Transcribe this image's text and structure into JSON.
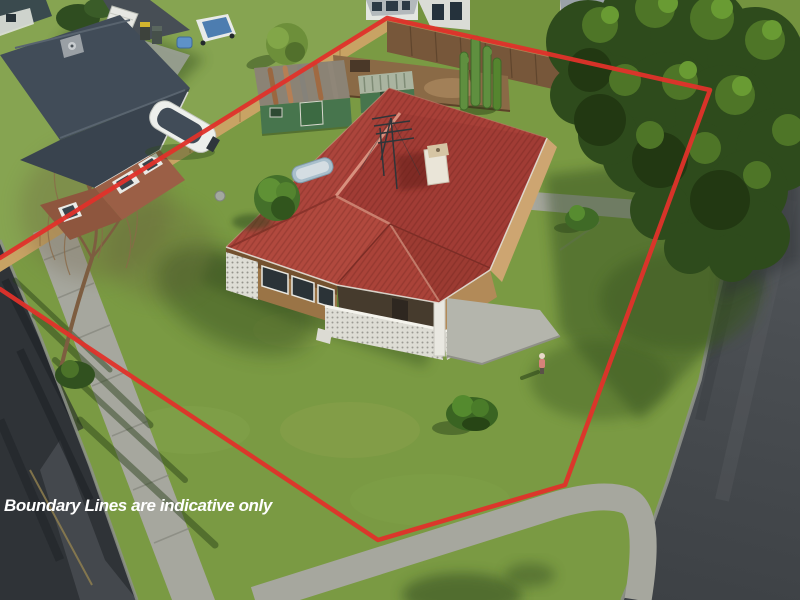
{
  "caption": {
    "text": "Boundary Lines are indicative only"
  },
  "overlay": {
    "points": "0,258 387,18 710,90 565,485 378,540 0,289",
    "description": "red property boundary outline"
  },
  "objects": [
    "main house with red corrugated hip roof",
    "white chimney",
    "tv antenna",
    "breeze-block balustrade and patio",
    "back fence",
    "two green garden sheds",
    "cactus plant",
    "large trees on right",
    "bare birch tree on left",
    "neighbour house with dark roof and boat",
    "wheelie bins",
    "corner roads with kerbs",
    "concrete footpaths",
    "person on lawn",
    "garden shrubs"
  ],
  "colors": {
    "lawn": "#7a9a43",
    "lawn2": "#86a451",
    "lawn-top": "#74933f",
    "road-dark": "#2f3337",
    "curb": "#8d908a",
    "path": "#a6a79e",
    "roof": "#a84038",
    "fence": "#77573a",
    "fence-lit": "#c8a364",
    "brick": "#9a7446",
    "brick-lit": "#cda571",
    "block": "#deddd5",
    "patio": "#b4b5ac",
    "tree": "#2e4b1c",
    "tree-hi": "#4e7527",
    "shed": "#47754d",
    "shed-roof": "#8b8375",
    "nroof": "#414c58",
    "nbrick": "#9b5f46",
    "dirt": "#8a6a46",
    "shadow": "#2e4a1c",
    "boundary": "#e0322a",
    "caption": "#ffffff"
  }
}
